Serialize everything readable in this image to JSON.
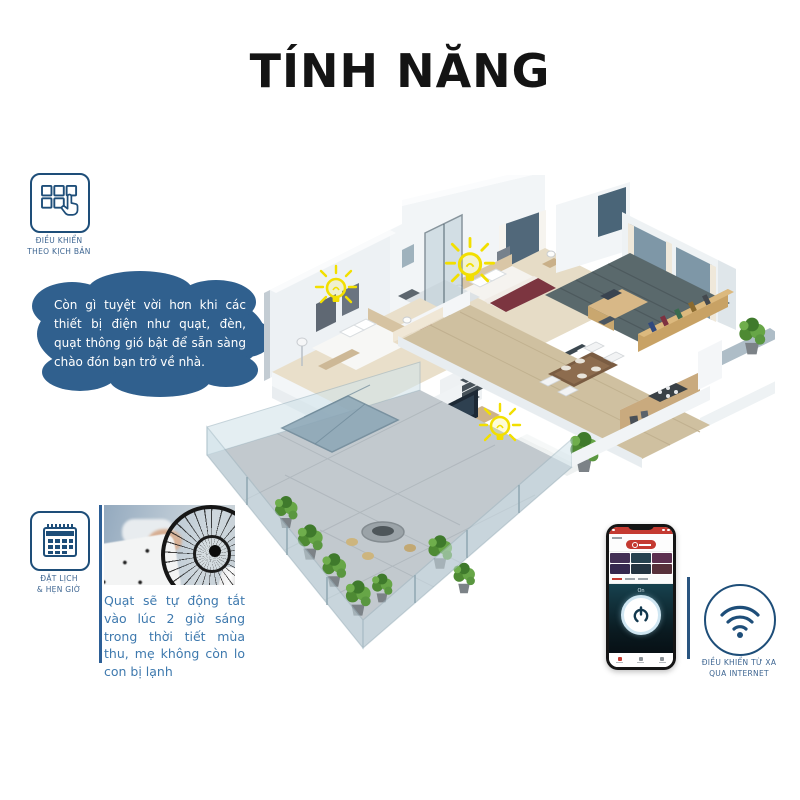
{
  "title": "TÍNH NĂNG",
  "features": {
    "scenario": {
      "icon": "grid-tap-icon",
      "label_line1": "ĐIỀU KHIỂN",
      "label_line2": "THEO KỊCH BẢN"
    },
    "schedule": {
      "icon": "calendar-icon",
      "label_line1": "ĐẶT LỊCH",
      "label_line2": "& HẸN GIỜ"
    },
    "remote": {
      "icon": "wifi-icon",
      "label_line1": "ĐIỀU KHIỂN TỪ XA",
      "label_line2": "QUA INTERNET"
    }
  },
  "callout_bubble": {
    "text": "Còn gì tuyệt vời hơn khi các thiết bị điện như quạt, đèn, quạt thông gió bật để sẵn sàng chào đón bạn trở về nhà."
  },
  "schedule_story": {
    "text": "Quạt sẽ tự động tắt vào lúc 2 giờ sáng trong thời tiết mùa thu, mẹ không còn lo con bị lạnh"
  },
  "phone_mockup": {
    "power_state_label": "On"
  },
  "colors": {
    "accent_navy": "#1e4e79",
    "label_blue": "#3d6591",
    "bubble_blue": "#30608e",
    "story_text_blue": "#3e79ae",
    "bulb_yellow": "#f2df00",
    "phone_red": "#c43a31",
    "title_black": "#141414"
  }
}
